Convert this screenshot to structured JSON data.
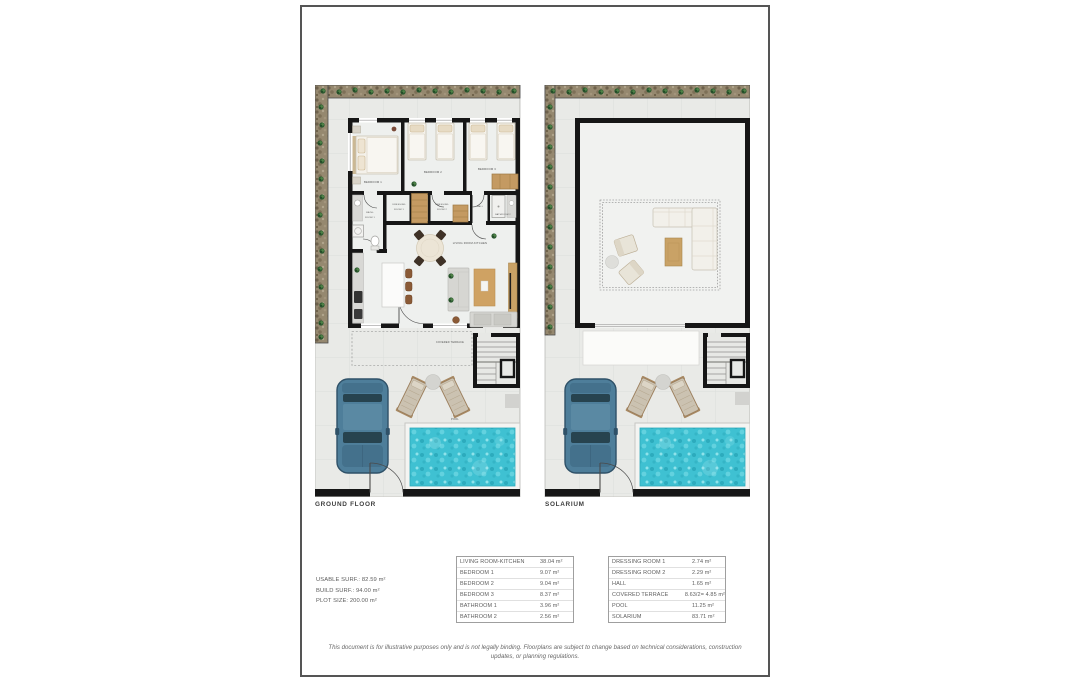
{
  "floors": {
    "ground": {
      "label": "GROUND FLOOR"
    },
    "solarium": {
      "label": "SOLARIUM"
    }
  },
  "plan": {
    "bedroom1": "BEDROOM 1",
    "bedroom2": "BEDROOM 2",
    "bedroom3": "BEDROOM 3",
    "dr1a": "DRESSING",
    "dr1b": "ROOM 1",
    "dr2a": "DRESSING",
    "dr2b": "ROOM 2",
    "hall": "HALL",
    "bath1a": "BATH-",
    "bath1b": "ROOM 1",
    "bathroom2": "BATHROOM 2",
    "living": "LIVING ROOM-KITCHEN",
    "covered_terrace": "COVERED TERRACE",
    "pool": "POOL"
  },
  "summary": {
    "usable": "USABLE SURF.: 82.59 m²",
    "build": "BUILD SURF.: 94.00 m²",
    "plot": "PLOT SIZE: 200.00 m²"
  },
  "area_tables": [
    {
      "rows": [
        {
          "name": "LIVING ROOM-KITCHEN",
          "value": "38.04 m²"
        },
        {
          "name": "BEDROOM 1",
          "value": "9.07 m²"
        },
        {
          "name": "BEDROOM 2",
          "value": "9.04 m²"
        },
        {
          "name": "BEDROOM 3",
          "value": "8.37 m²"
        },
        {
          "name": "BATHROOM 1",
          "value": "3.96 m²"
        },
        {
          "name": "BATHROOM 2",
          "value": "2.56 m²"
        }
      ]
    },
    {
      "rows": [
        {
          "name": "DRESSING ROOM 1",
          "value": "2.74 m²"
        },
        {
          "name": "DRESSING ROOM 2",
          "value": "2.29 m²"
        },
        {
          "name": "HALL",
          "value": "1.65 m²"
        },
        {
          "name": "COVERED TERRACE",
          "value": "8.63/2= 4.85 m²"
        },
        {
          "name": "POOL",
          "value": "11.25 m²"
        },
        {
          "name": "SOLARIUM",
          "value": "83.71 m²"
        }
      ]
    }
  ],
  "disclaimer": "This document is for illustrative purposes only and is not legally binding. Floorplans are subject to change based on technical considerations, construction updates, or planning regulations.",
  "colors": {
    "pool_water": "#3fc1d2",
    "car_body": "#4e7e9a",
    "walls": "#161616",
    "wood": "#c9a266",
    "gravel": "#95886f"
  }
}
